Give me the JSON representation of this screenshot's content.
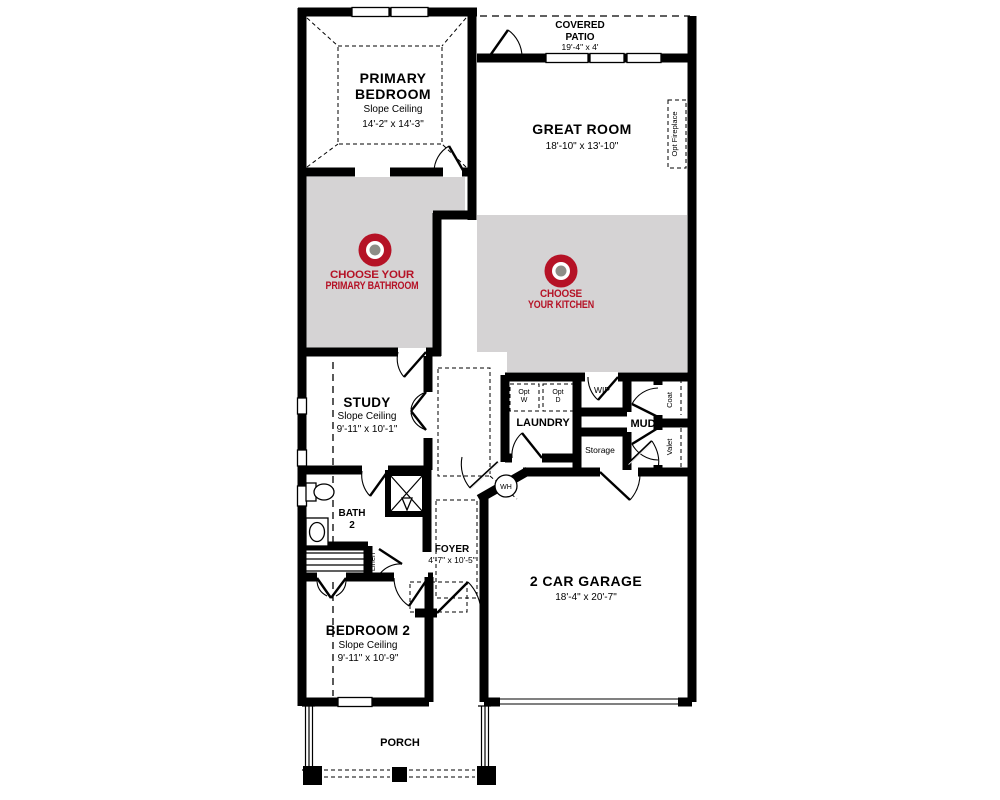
{
  "colors": {
    "wall": "#000000",
    "highlight_zone": "#d5d3d4",
    "accent_red": "#b51226",
    "marker_center": "#8d8d87",
    "background": "#ffffff"
  },
  "rooms": {
    "primary_bedroom": {
      "line1": "PRIMARY",
      "line2": "BEDROOM",
      "note": "Slope Ceiling",
      "dims": "14'-2\" x 14'-3\""
    },
    "covered_patio": {
      "line1": "COVERED",
      "line2": "PATIO",
      "dims": "19'-4\" x 4'"
    },
    "great_room": {
      "name": "GREAT ROOM",
      "dims": "18'-10\" x 13'-10\""
    },
    "study": {
      "name": "STUDY",
      "note": "Slope Ceiling",
      "dims": "9'-11\" x 10'-1\""
    },
    "laundry": {
      "name": "LAUNDRY"
    },
    "wip": {
      "name": "WIP"
    },
    "mud": {
      "name": "MUD"
    },
    "storage": {
      "name": "Storage"
    },
    "coat": {
      "name": "Coat"
    },
    "valet": {
      "name": "Valet"
    },
    "bath_2": {
      "line1": "BATH",
      "line2": "2"
    },
    "linen": {
      "name": "Linen"
    },
    "foyer": {
      "name": "FOYER",
      "dims": "4'-7\" x 10'-5\""
    },
    "bedroom_2": {
      "name": "BEDROOM 2",
      "note": "Slope Ceiling",
      "dims": "9'-11\" x 10'-9\""
    },
    "garage": {
      "name": "2 CAR GARAGE",
      "dims": "18'-4\" x 20'-7\""
    },
    "porch": {
      "name": "PORCH"
    },
    "water_heater": {
      "abbr": "WH"
    },
    "opt_fireplace": {
      "name": "Opt Fireplace"
    },
    "opt_washer": {
      "line1": "Opt",
      "line2": "W"
    },
    "opt_dryer": {
      "line1": "Opt",
      "line2": "D"
    }
  },
  "markers": {
    "primary_bathroom": {
      "line1": "CHOOSE YOUR",
      "line2": "PRIMARY BATHROOM"
    },
    "kitchen": {
      "line1": "CHOOSE",
      "line2": "YOUR KITCHEN"
    }
  }
}
